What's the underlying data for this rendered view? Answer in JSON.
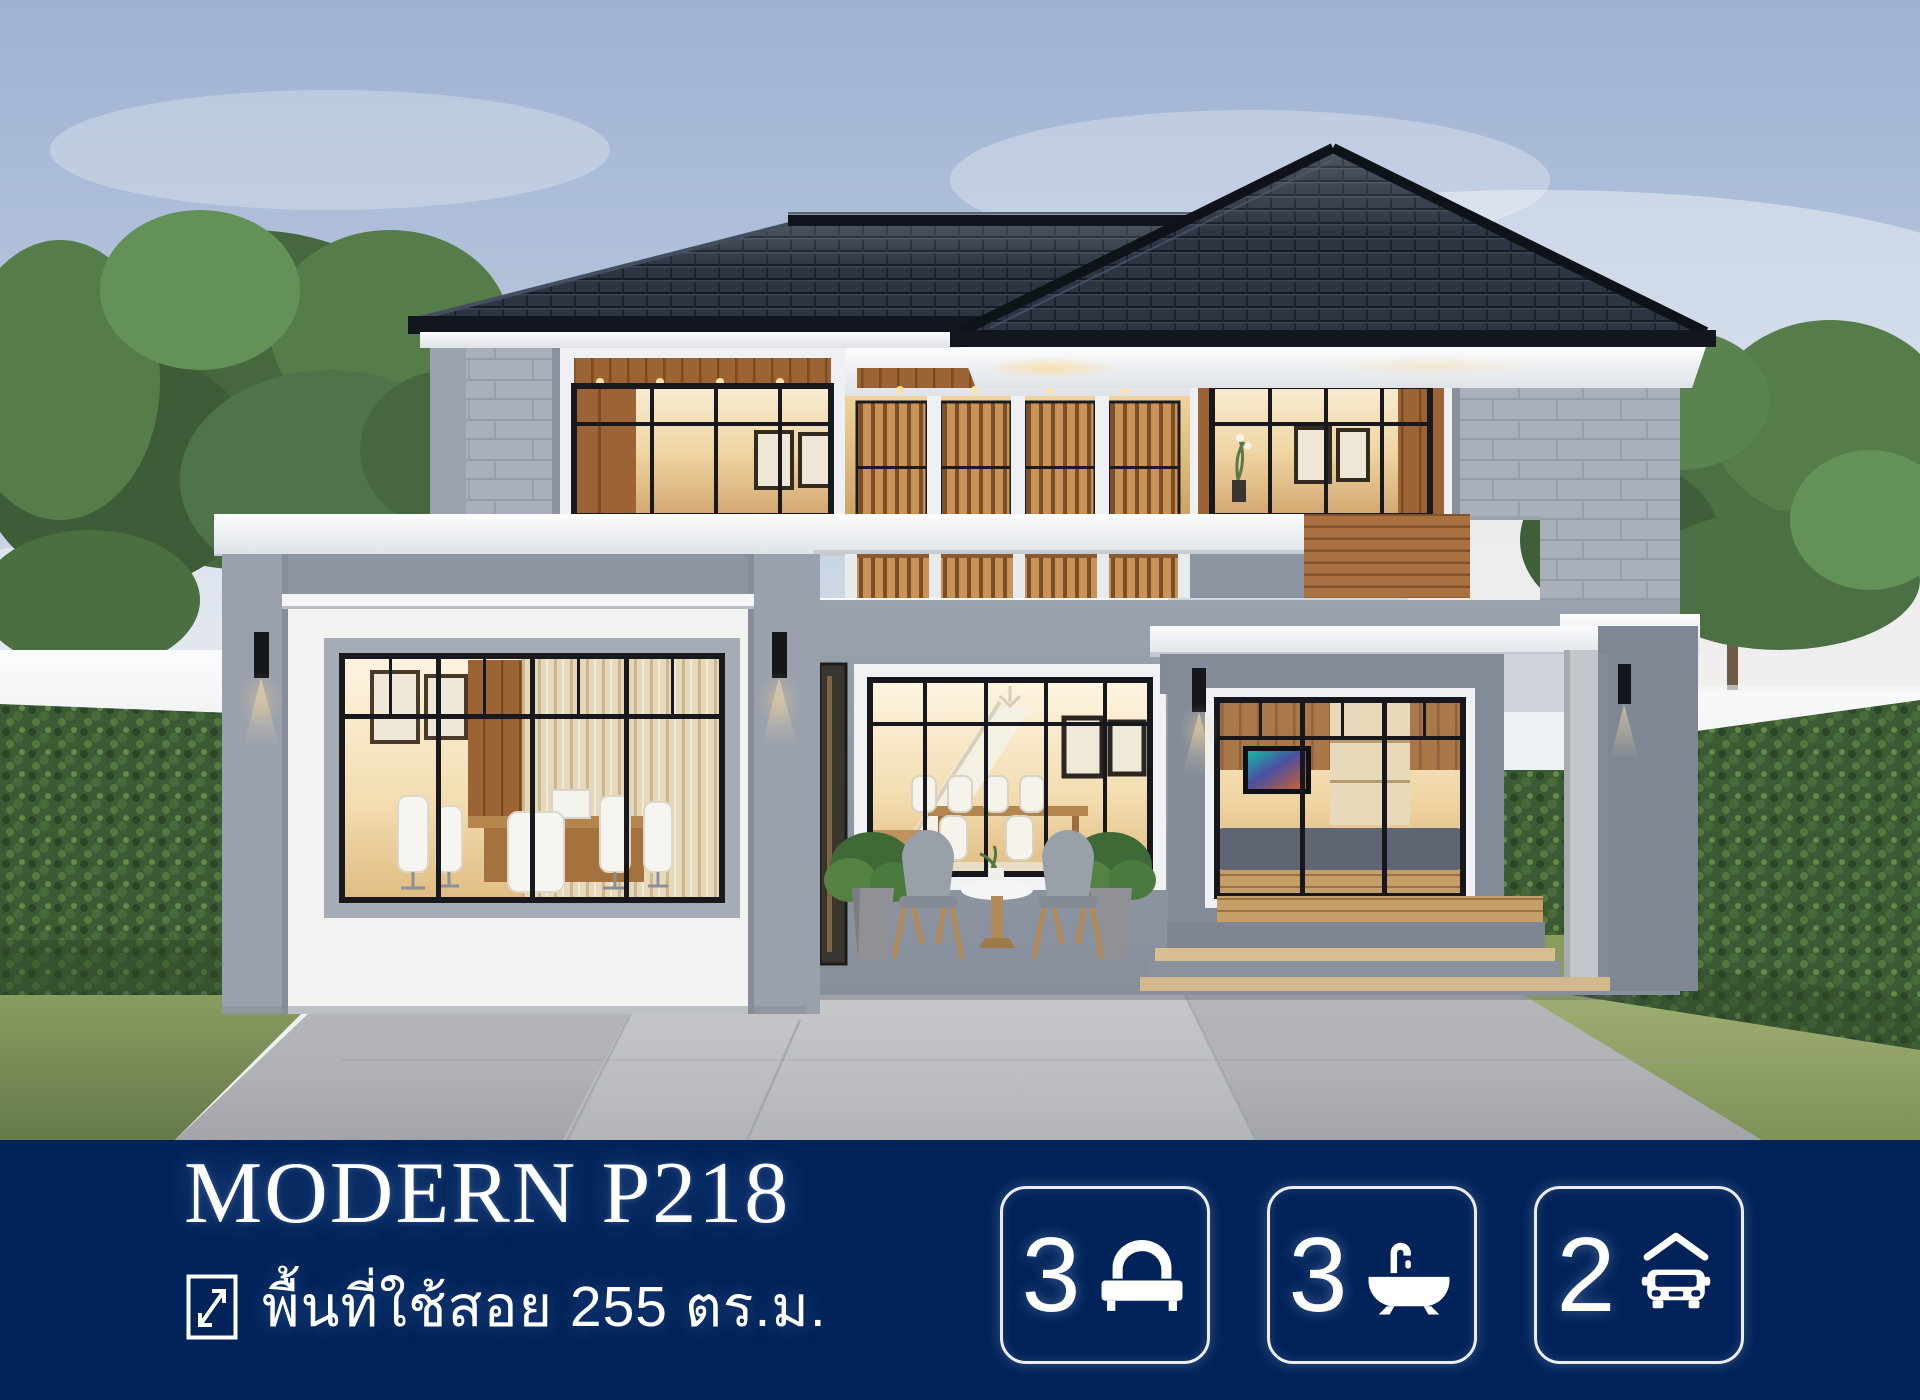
{
  "banner": {
    "background_color": "#01235A",
    "text_color": "#FFFFFF",
    "title": "MODERN P218",
    "area": {
      "icon": "expand-arrow-icon",
      "text": "พื้นที่ใช้สอย 255 ตร.ม."
    },
    "badges": [
      {
        "icon": "bed-icon",
        "value": "3"
      },
      {
        "icon": "bathtub-icon",
        "value": "3"
      },
      {
        "icon": "car-icon",
        "value": "2"
      }
    ]
  },
  "scene": {
    "colors": {
      "sky_top": "#9FB2D3",
      "sky_horizon": "#F1F3F4",
      "roof_tile": "#2D3442",
      "wall_gray": "#99A1AE",
      "wall_white": "#F3F3F2",
      "stone": "#AAB0B9",
      "wood": "#9C6434",
      "window_glow": "#F0D6A4",
      "hedge_green": "#3C5A34",
      "grass_green": "#7E9158",
      "driveway": "#B3B5B9",
      "fence_white": "#EFF1F4"
    }
  }
}
